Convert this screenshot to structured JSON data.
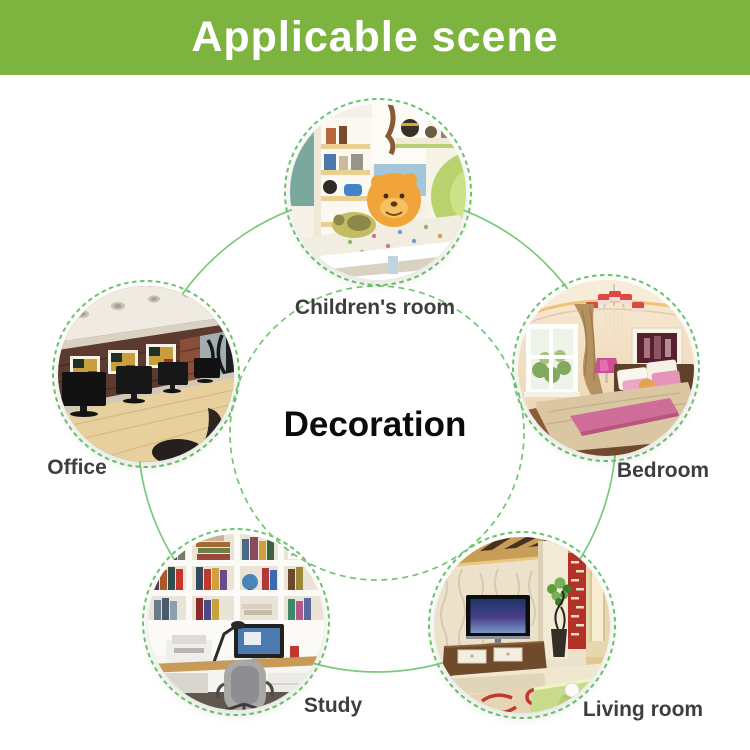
{
  "header": {
    "title": "Applicable scene"
  },
  "center": {
    "label": "Decoration"
  },
  "scenes": [
    {
      "id": "childrens-room",
      "label": "Children's room"
    },
    {
      "id": "office",
      "label": "Office"
    },
    {
      "id": "bedroom",
      "label": "Bedroom"
    },
    {
      "id": "study",
      "label": "Study"
    },
    {
      "id": "living-room",
      "label": "Living room"
    }
  ],
  "colors": {
    "header_bg": "#7db43f",
    "header_text": "#ffffff",
    "orbit_line_solid": "#7cc87c",
    "orbit_line_dashed": "#72c572",
    "circle_ring_dashed": "#6cc46c",
    "label_text": "#3e3e3e",
    "center_text": "#0b0b0b",
    "background": "#ffffff"
  }
}
